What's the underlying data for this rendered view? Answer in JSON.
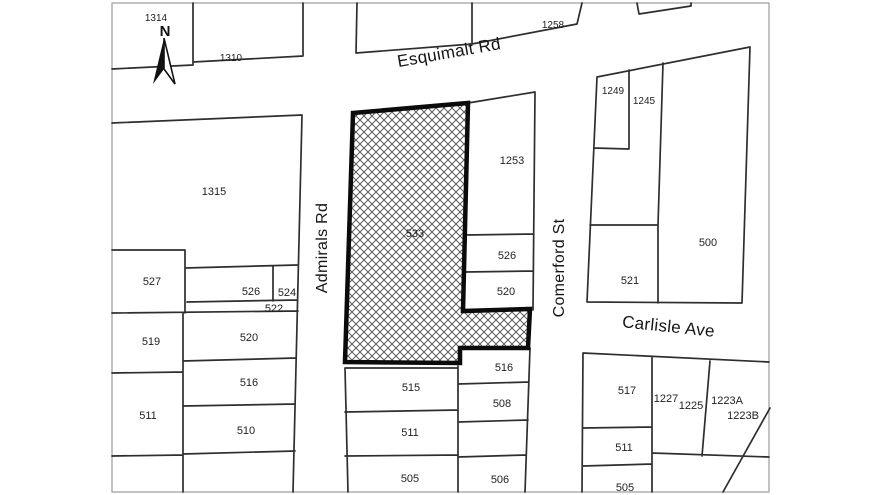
{
  "map": {
    "kind": "cadastral parcel map",
    "region": {
      "north_indicator": "N"
    },
    "highlighted_parcel": {
      "number": "533",
      "pattern": "crosshatch"
    },
    "streets": [
      {
        "name": "Esquimalt Rd",
        "orientation": "horizontal"
      },
      {
        "name": "Admirals Rd",
        "orientation": "vertical"
      },
      {
        "name": "Comerford St",
        "orientation": "vertical"
      },
      {
        "name": "Carlisle Ave",
        "orientation": "horizontal"
      }
    ],
    "parcels": [
      {
        "number": "1314"
      },
      {
        "number": "1310"
      },
      {
        "number": "1258"
      },
      {
        "number": "1249"
      },
      {
        "number": "1245"
      },
      {
        "number": "1253"
      },
      {
        "number": "1315"
      },
      {
        "number": "533"
      },
      {
        "number": "500"
      },
      {
        "number": "526"
      },
      {
        "number": "521"
      },
      {
        "number": "527"
      },
      {
        "number": "526"
      },
      {
        "number": "524"
      },
      {
        "number": "522"
      },
      {
        "number": "520"
      },
      {
        "number": "519"
      },
      {
        "number": "520"
      },
      {
        "number": "516"
      },
      {
        "number": "516"
      },
      {
        "number": "515"
      },
      {
        "number": "508"
      },
      {
        "number": "511"
      },
      {
        "number": "510"
      },
      {
        "number": "511"
      },
      {
        "number": "517"
      },
      {
        "number": "1227"
      },
      {
        "number": "1225"
      },
      {
        "number": "1223A"
      },
      {
        "number": "1223B"
      },
      {
        "number": "511"
      },
      {
        "number": "505"
      },
      {
        "number": "506"
      },
      {
        "number": "505"
      }
    ]
  },
  "colors": {
    "background": "#ffffff",
    "parcel_line": "#2e2e2e",
    "map_frame": "#9b9b9b",
    "highlight_border": "#0b0b0b",
    "hatch_line": "#4a4a4a",
    "label_text": "#1f1f1f"
  }
}
